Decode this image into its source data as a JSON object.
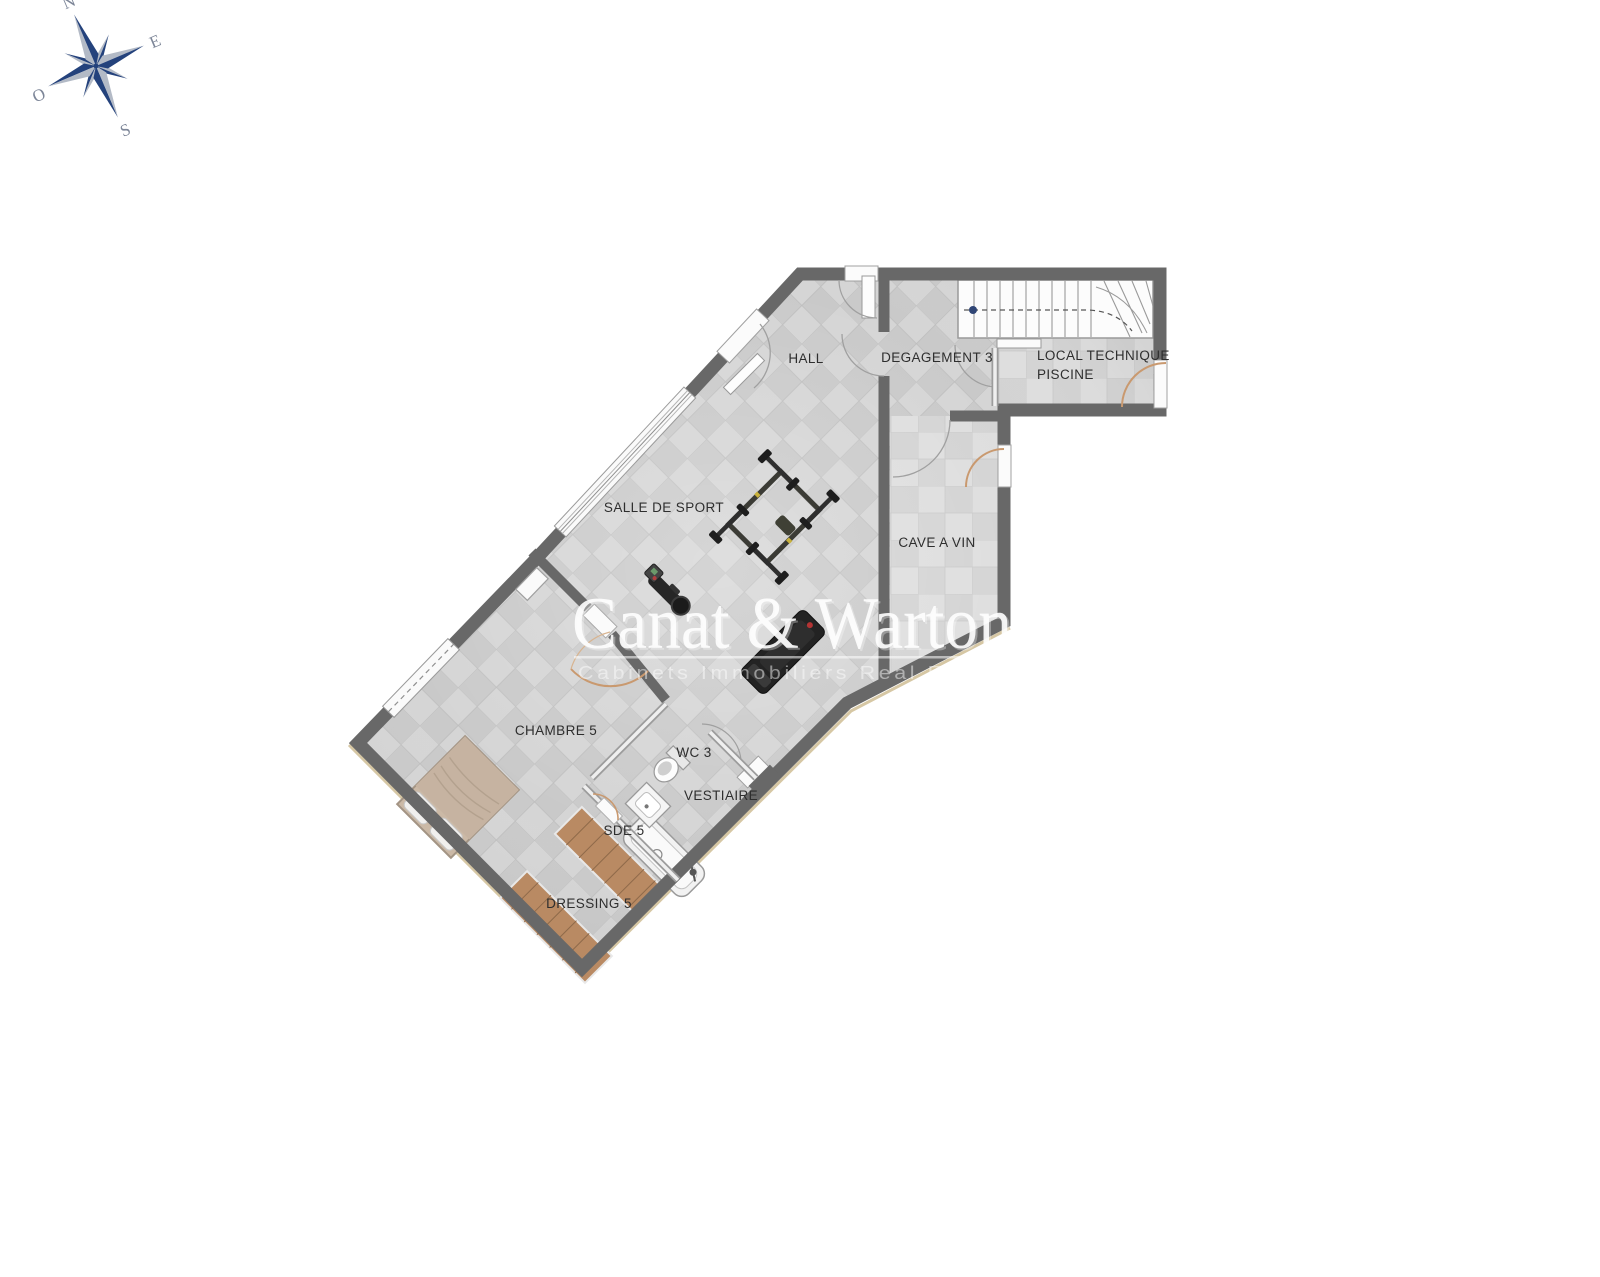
{
  "compass": {
    "n": "N",
    "e": "E",
    "s": "S",
    "o": "O"
  },
  "rooms": {
    "hall": "HALL",
    "degagement": "DEGAGEMENT 3",
    "local_technique_line1": "LOCAL TECHNIQUE",
    "local_technique_line2": "PISCINE",
    "salle_de_sport": "SALLE DE SPORT",
    "cave_a_vin": "CAVE A VIN",
    "chambre": "CHAMBRE 5",
    "wc": "WC 3",
    "vestiaire": "VESTIAIRE",
    "sde": "SDE 5",
    "dressing": "DRESSING 5"
  },
  "watermark": {
    "name": "Canat & Warton",
    "tagline": "Cabinets Immobiliers Real Estate"
  },
  "colors": {
    "wall": "#686868",
    "floor": "#cfcfcf",
    "cave_floor": "#d9d9d9",
    "door_arc_tan": "#c9996f",
    "wood": "#b98a63",
    "compass_navy": "#24427c",
    "compass_silver": "#b3bac6",
    "label_text": "#2e2e2e"
  }
}
